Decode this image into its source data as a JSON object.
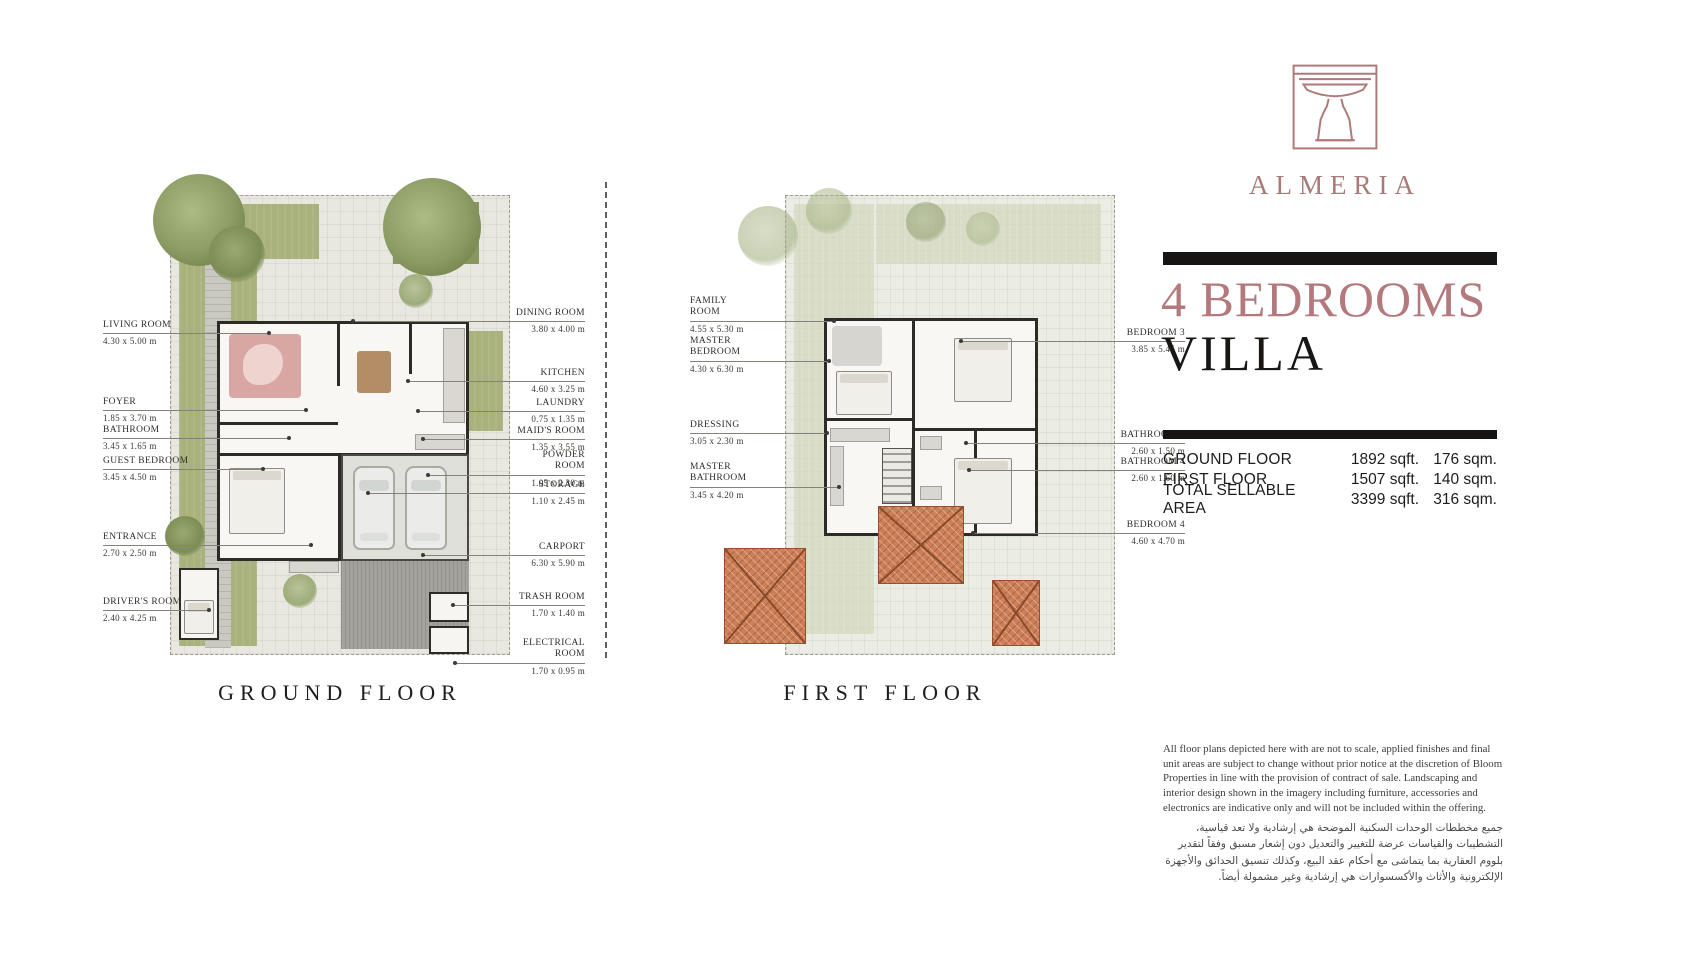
{
  "brand": {
    "name": "ALMERIA",
    "accent_color": "#ad7a78",
    "logo_icon": "fountain-icon"
  },
  "title": {
    "line1": "4 BEDROOMS",
    "line2": "VILLA",
    "line1_color": "#b4797c",
    "line2_color": "#181716"
  },
  "area_table": {
    "rows": [
      {
        "label": "GROUND FLOOR",
        "sqft": "1892 sqft.",
        "sqm": "176 sqm."
      },
      {
        "label": "FIRST FLOOR",
        "sqft": "1507 sqft.",
        "sqm": "140 sqm."
      },
      {
        "label": "TOTAL SELLABLE AREA",
        "sqft": "3399 sqft.",
        "sqm": "316 sqm."
      }
    ]
  },
  "plans": [
    {
      "caption": "GROUND FLOOR",
      "labels_left": [
        {
          "name": "LIVING ROOM",
          "dim": "4.30 x 5.00 m"
        },
        {
          "name": "FOYER",
          "dim": "1.85 x 3.70 m"
        },
        {
          "name": "BATHROOM",
          "dim": "3.45 x 1.65 m"
        },
        {
          "name": "GUEST BEDROOM",
          "dim": "3.45 x 4.50 m"
        },
        {
          "name": "ENTRANCE",
          "dim": "2.70 x 2.50 m"
        },
        {
          "name": "DRIVER'S ROOM",
          "dim": "2.40 x 4.25 m"
        }
      ],
      "labels_right": [
        {
          "name": "DINING ROOM",
          "dim": "3.80 x 4.00 m"
        },
        {
          "name": "KITCHEN",
          "dim": "4.60 x 3.25 m"
        },
        {
          "name": "LAUNDRY",
          "dim": "0.75 x 1.35 m"
        },
        {
          "name": "MAID'S ROOM",
          "dim": "1.35 x 3.55 m"
        },
        {
          "name": "POWDER ROOM",
          "dim": "1.05 x 2.30 m"
        },
        {
          "name": "STORAGE",
          "dim": "1.10 x 2.45 m"
        },
        {
          "name": "CARPORT",
          "dim": "6.30 x 5.90 m"
        },
        {
          "name": "TRASH ROOM",
          "dim": "1.70 x 1.40 m"
        },
        {
          "name": "ELECTRICAL ROOM",
          "dim": "1.70 x 0.95 m"
        }
      ]
    },
    {
      "caption": "FIRST FLOOR",
      "labels_left": [
        {
          "name": "FAMILY ROOM",
          "dim": "4.55 x 5.30 m"
        },
        {
          "name": "MASTER BEDROOM",
          "dim": "4.30 x 6.30 m"
        },
        {
          "name": "DRESSING",
          "dim": "3.05 x 2.30 m"
        },
        {
          "name": "MASTER BATHROOM",
          "dim": "3.45 x 4.20 m"
        }
      ],
      "labels_right": [
        {
          "name": "BEDROOM 3",
          "dim": "3.85 x 5.45 m"
        },
        {
          "name": "BATHROOM 3",
          "dim": "2.60 x 1.50 m"
        },
        {
          "name": "BATHROOM 4",
          "dim": "2.60 x 1.60 m"
        },
        {
          "name": "BEDROOM 4",
          "dim": "4.60 x 4.70 m"
        }
      ]
    }
  ],
  "disclaimer_en": "All floor plans depicted here with are not to scale, applied finishes and final unit areas are subject to change without prior notice at the discretion of Bloom Properties in line with the provision of contract of sale. Landscaping and interior design shown in the imagery including furniture, accessories and electronics are indicative only and will not be included within the offering.",
  "disclaimer_ar": "جميع مخططات الوحدات السكنية الموضحة هي إرشادية ولا تعد قياسية، التشطيبات والقياسات عرضة للتغيير والتعديل دون إشعار مسبق وفقاً لتقدير بلووم العقارية بما يتماشى مع أحكام عقد البيع، وكذلك تنسيق الحدائق والأجهزة الإلكترونية والأثاث والأكسسوارات هي إرشادية وغير مشمولة أيضاً."
}
